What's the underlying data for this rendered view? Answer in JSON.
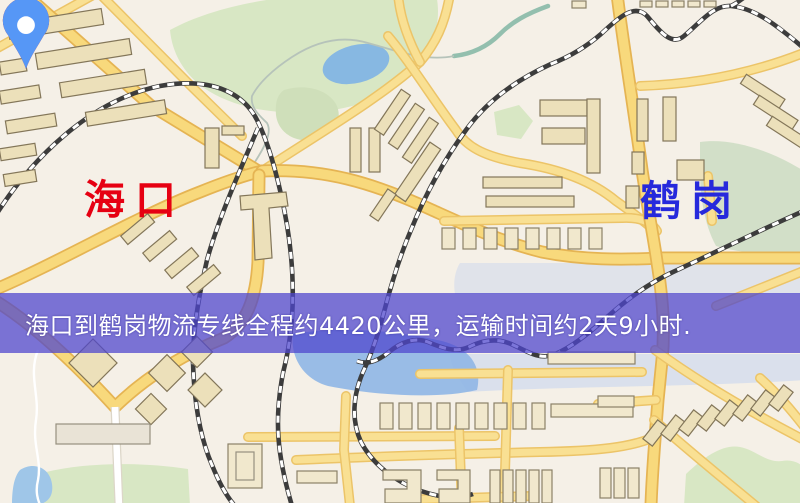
{
  "map": {
    "markers": [
      {
        "id": "origin",
        "label": "海口",
        "pin": "red-map-pin",
        "pin_color": "#ee1606",
        "label_color": "#e60012"
      },
      {
        "id": "destination",
        "label": "鹤岗",
        "pin": "blue-map-pin",
        "pin_color": "#5697f6",
        "label_color": "#2629dc"
      }
    ]
  },
  "banner": {
    "text": "海口到鹤岗物流专线全程约4420公里，运输时间约2天9小时.",
    "background_color": "#4e46cd",
    "text_color": "#ffffff",
    "distance_km": "4420",
    "transit_time": "2天9小时"
  }
}
